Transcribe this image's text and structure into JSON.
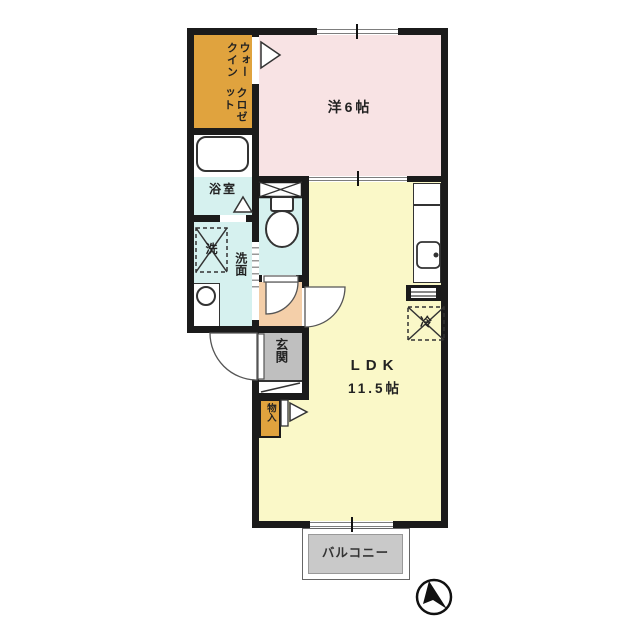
{
  "colors": {
    "wall": "#1b1b1b",
    "room_orange": "#e0a33e",
    "room_pink": "#f8e3e4",
    "room_cyan": "#d6f1ef",
    "room_yellow": "#faf8c8",
    "hallway_peach": "#f4cfa9",
    "entrance_gray": "#bfbfbf",
    "balcony_gray": "#c9c9c9"
  },
  "rooms": {
    "walk_in_closet": {
      "label_line1": "ウォークイン",
      "label_line2": "クロゼット"
    },
    "western_room": {
      "label": "洋6帖"
    },
    "bathroom": {
      "label": "浴室"
    },
    "washroom": {
      "label": "洗面"
    },
    "washer": {
      "label": "洗"
    },
    "entrance": {
      "label": "玄関"
    },
    "storage": {
      "label": "物入"
    },
    "refrigerator": {
      "label": "冷"
    },
    "ldk": {
      "label": "LDK",
      "size": "11.5帖"
    },
    "balcony": {
      "label": "バルコニー"
    }
  },
  "icons": {
    "compass": "north-arrow-icon",
    "toilet": "toilet-icon",
    "bathtub": "bathtub-icon",
    "kitchen_sink": "kitchen-sink-icon",
    "wash_basin": "wash-basin-icon"
  }
}
